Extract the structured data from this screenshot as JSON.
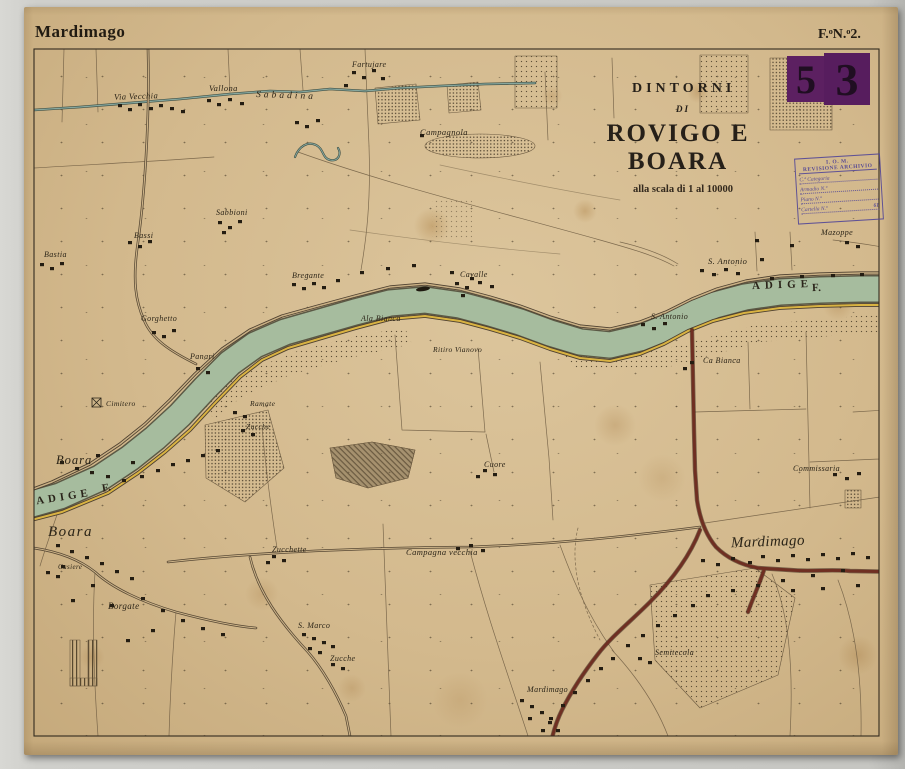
{
  "header": {
    "sheet_name": "Mardimago",
    "folio": "F.ᵒN.ᵒ2."
  },
  "stamp_53": {
    "digit1": "5",
    "digit2": "3",
    "color": "#5c2061"
  },
  "archive_stamp": {
    "org": "I. O. M.",
    "line": "REVISIONE ARCHIVIO",
    "fields": [
      {
        "label": "C.ª Categoria",
        "value": ""
      },
      {
        "label": "Armadio N.º",
        "value": ""
      },
      {
        "label": "Piano N.º",
        "value": ""
      },
      {
        "label": "Cartella N.º",
        "value": "61"
      }
    ]
  },
  "title": {
    "line1": "DINTORNI",
    "line2": "DI",
    "line3": "ROVIGO E BOARA",
    "scale": "alla scala di 1 al 10000"
  },
  "river": {
    "name": "ADIGE",
    "abbr": "F."
  },
  "colors": {
    "paper": "#d3b98d",
    "river": "#a6bc9e",
    "road_red": "#6f2f22",
    "levee_yellow": "#d9b342"
  },
  "places": {
    "via_vecchia": "Via Vecchia",
    "vallona": "Vallona",
    "sabadina": "Sabadina",
    "fartujare": "Fartujare",
    "campagnola": "Campagnola",
    "sabbioni": "Sabbioni",
    "bassi": "Bassi",
    "bastia": "Bastia",
    "gorghetto": "Gorghetto",
    "panari": "Panari",
    "bregante": "Bregante",
    "cavalle": "Cavalle",
    "ala_bianca": "Ala Bianca",
    "ritiro_vianovo": "Ritiro Vianovo",
    "s_antonio": "S. Antonio",
    "mazoppe": "Mazoppe",
    "ca_bianca": "Ca Bianca",
    "commissaria": "Commissaria",
    "cimitero": "Cimitero",
    "boara": "Boara",
    "ramate": "Ramate",
    "zucche": "Zucche",
    "casiere": "Casiere",
    "borgate": "Borgate",
    "zucchette": "Zucchette",
    "campagna_vecchia": "Campagna vecchia",
    "s_marco": "S. Marco",
    "mardimago": "Mardimago",
    "semitecola": "Semitecola",
    "cuore": "Cuore"
  }
}
